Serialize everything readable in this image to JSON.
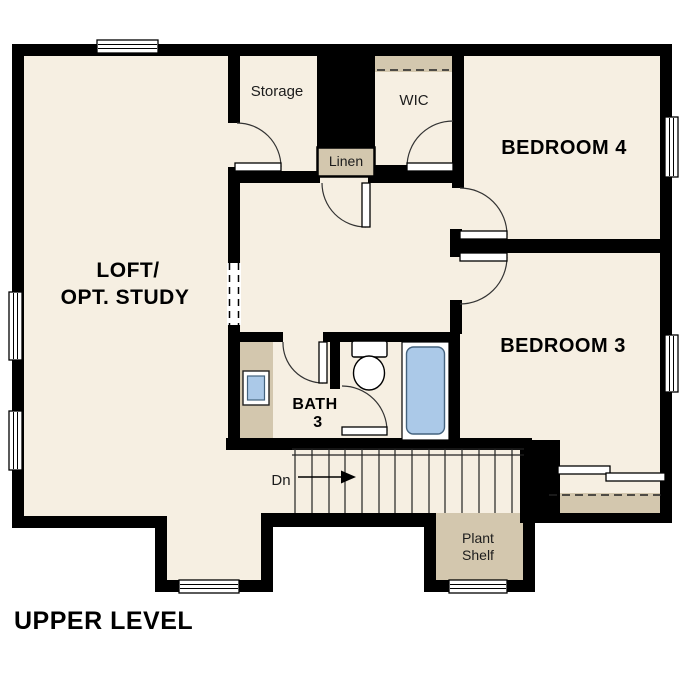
{
  "page": {
    "title": "UPPER LEVEL"
  },
  "floor_plan": {
    "rooms": {
      "loft_line1": "LOFT/",
      "loft_line2": "OPT. STUDY",
      "storage": "Storage",
      "wic": "WIC",
      "bedroom4": "BEDROOM 4",
      "bedroom3": "BEDROOM 3",
      "bath_line1": "BATH",
      "bath_line2": "3"
    },
    "features": {
      "linen": "Linen",
      "plant_shelf_line1": "Plant",
      "plant_shelf_line2": "Shelf",
      "stairs_direction": "Dn"
    },
    "colors": {
      "walls": "#000000",
      "floor": "#f6efe2",
      "shelves_tan": "#d3c7ae",
      "fixtures_blue": "#abc9e8",
      "fixture_outline": "#44637f",
      "background": "#ffffff"
    }
  }
}
